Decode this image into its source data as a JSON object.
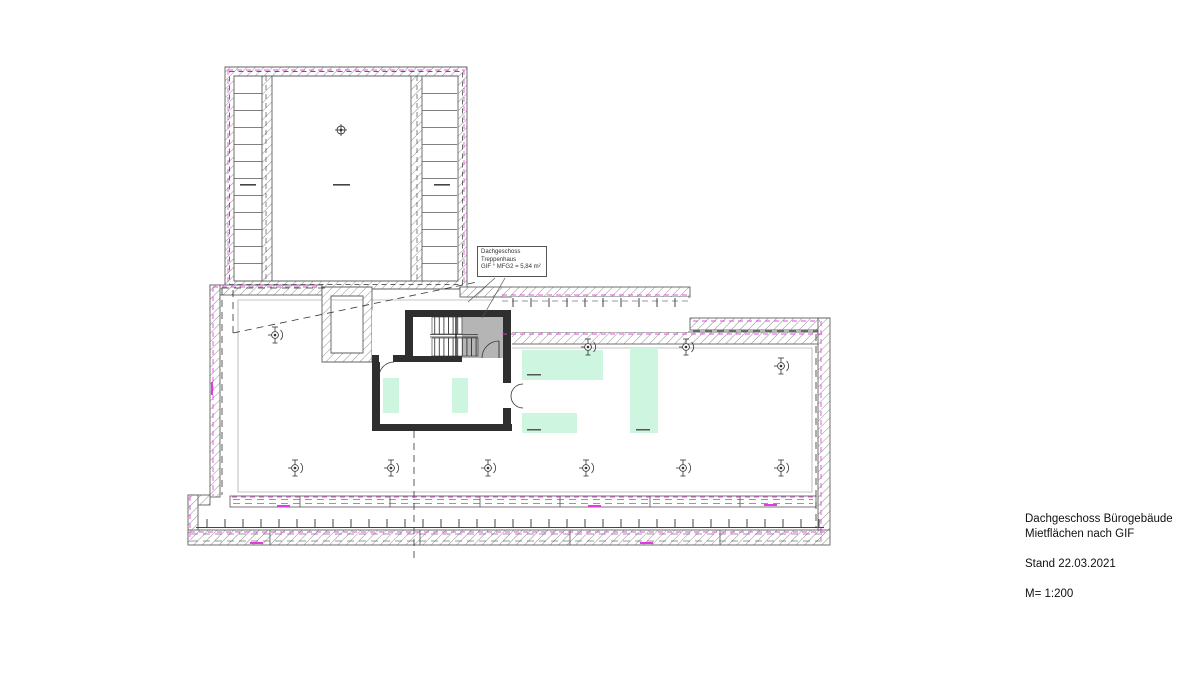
{
  "plan": {
    "annotation_box": {
      "line1": "Dachgeschoss",
      "line2": "Treppenhaus",
      "line3": "GIF ° MFG2 = 5,84 m²"
    }
  },
  "title_block": {
    "project": "Dachgeschoss Bürogebäude",
    "subtitle": "Mietflächen nach GIF",
    "date_line": "Stand 22.03.2021",
    "scale_line": "M= 1:200"
  },
  "colors": {
    "highlight_green": "#cdf5e0",
    "boundary_magenta": "#e23ae2",
    "wall_dark": "#2f2f2f",
    "wall_hatch_gray": "#8f8f8f",
    "stair_fill_gray": "#b5b5b5",
    "roof_edge_gray": "#c4c4c4"
  }
}
